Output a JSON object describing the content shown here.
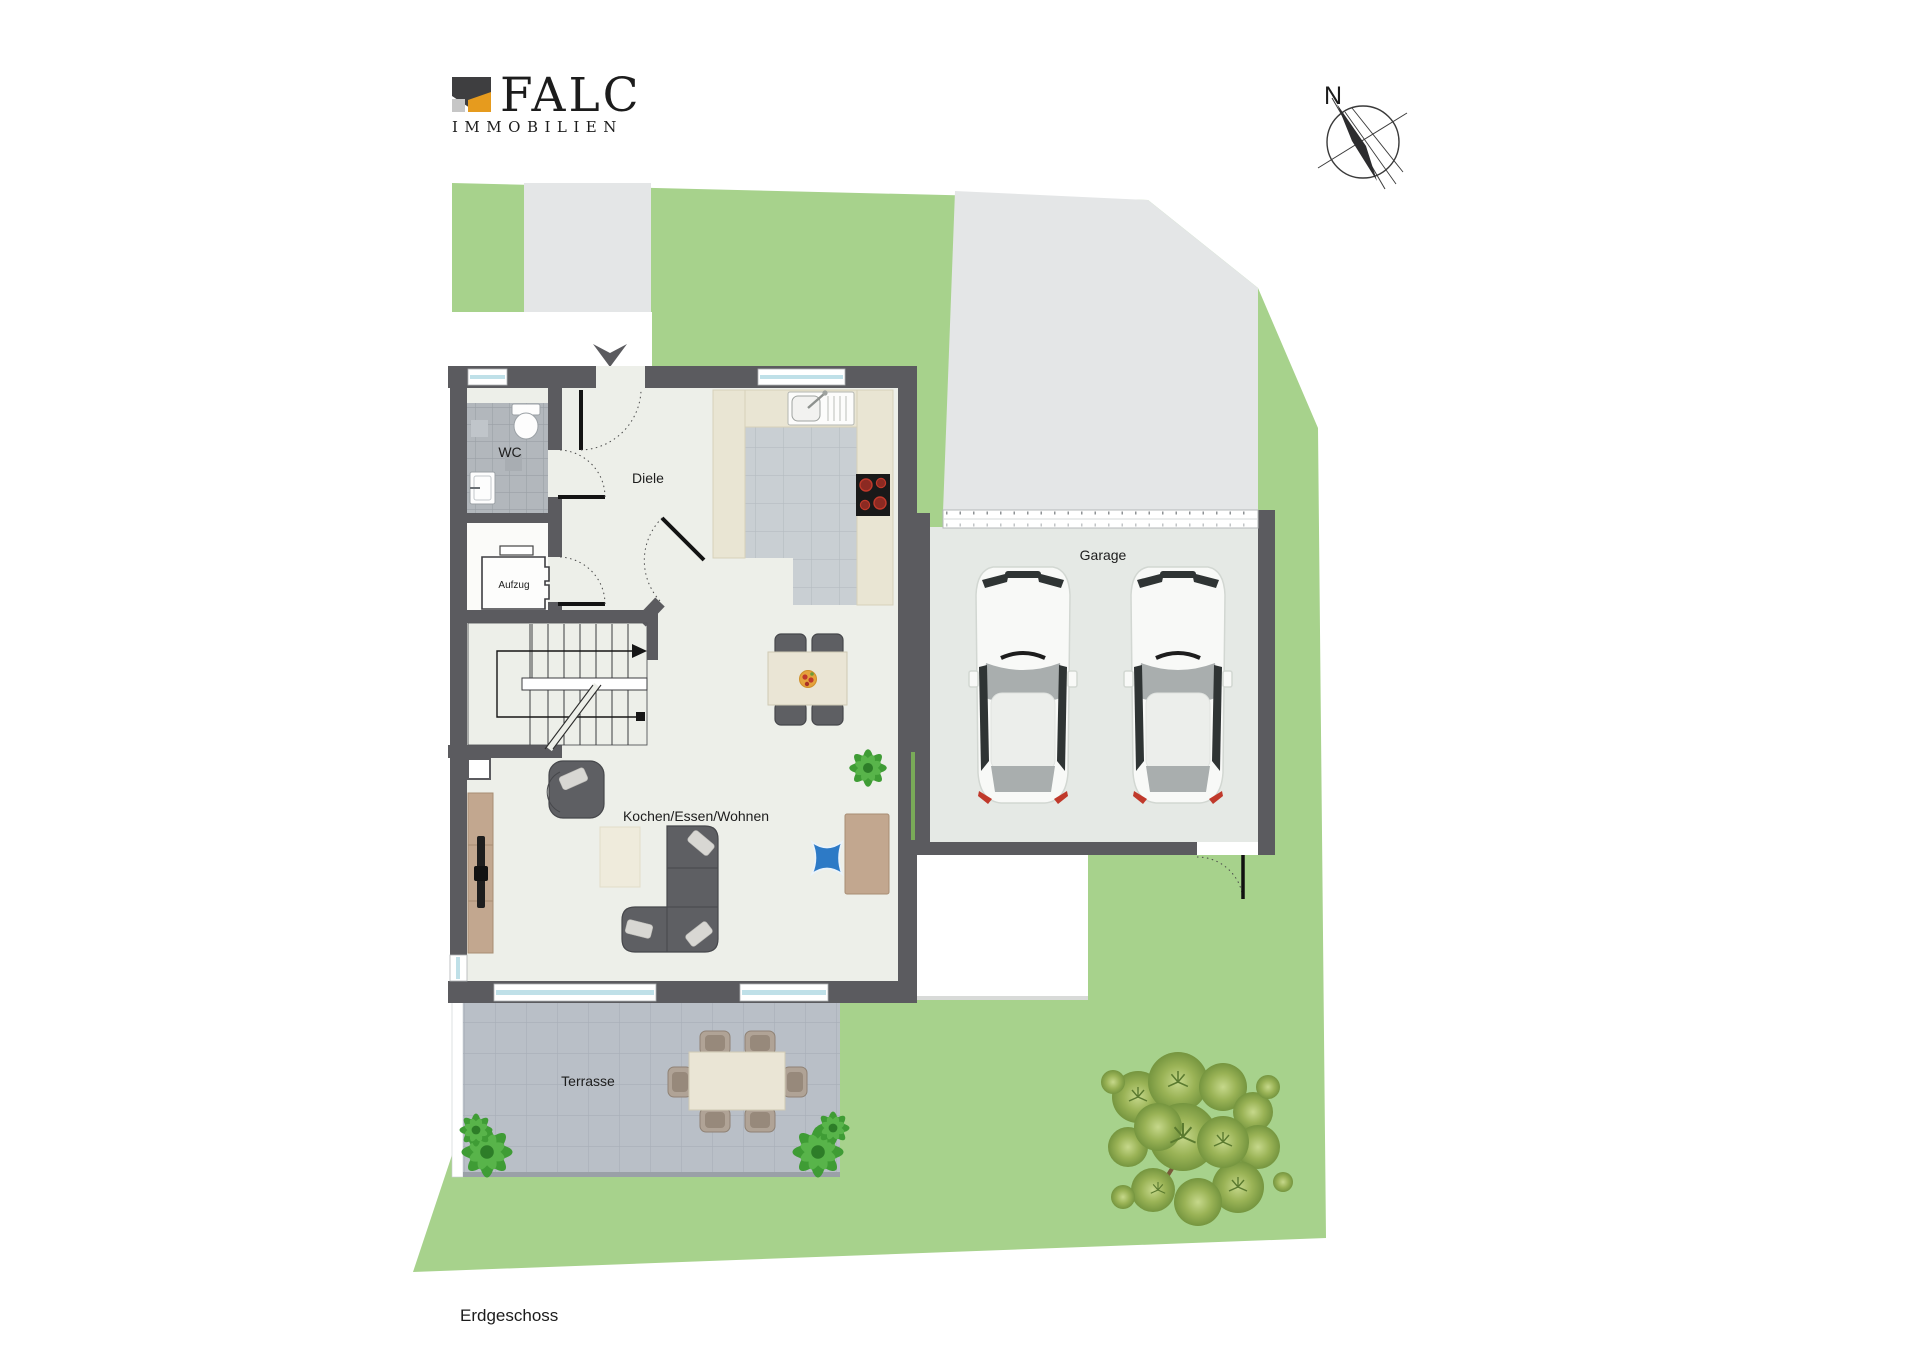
{
  "logo": {
    "brand": "FALC",
    "subtitle": "IMMOBILIEN"
  },
  "compass": {
    "label": "N"
  },
  "plan": {
    "floor_label": "Erdgeschoss",
    "rooms": [
      {
        "name": "wc",
        "label": "WC"
      },
      {
        "name": "diele",
        "label": "Diele"
      },
      {
        "name": "aufzug",
        "label": "Aufzug"
      },
      {
        "name": "garage",
        "label": "Garage"
      },
      {
        "name": "living",
        "label": "Kochen/Essen/Wohnen"
      },
      {
        "name": "terrace",
        "label": "Terrasse"
      }
    ],
    "features": [
      "entrance-arrow",
      "stairs",
      "double-garage-two-cars",
      "terrace-dining-set",
      "garden-bush",
      "compass-north"
    ]
  },
  "colors": {
    "grass": "#a7d28c",
    "pave": "#e4e6e7",
    "wall": "#5b5b5f",
    "floor": "#edefe9",
    "lobby": "#fbfbf9",
    "wcTile": "#b2b7bc",
    "wcGrid": "#9aa0a6",
    "kitchenTile": "#c9cfd3",
    "kitchenGrid": "#b5bcc1",
    "counter": "#e9e5d3",
    "counterEdge": "#d6d1ba",
    "garageFloor": "#e5e9e5",
    "terraceTile": "#b9bfc7",
    "terraceGrid": "#a8aeb7",
    "furnDark": "#5e5f63",
    "furnDarkEdge": "#46474b",
    "pillow": "#d8d7d3",
    "rug": "#efebdc",
    "wood": "#c2a78f",
    "woodEdge": "#a88d73",
    "cream": "#eae5d5",
    "creamEdge": "#cfc9b4",
    "blue": "#2d7ac6",
    "carBody": "#f8f9f7",
    "carEdge": "#d2d7d2",
    "carGlassDark": "#2f3434",
    "carGray": "#a9aeae",
    "red": "#c0392b",
    "burner": "#8c2a22",
    "plantGreen": "#3f9c35",
    "plantDark": "#2d7d28",
    "glass": "#bfe0e8",
    "logoOrange": "#e2981f",
    "logoDark": "#3a3a3c",
    "logoGray": "#c6c6c6",
    "ink": "#1c1c1c"
  }
}
